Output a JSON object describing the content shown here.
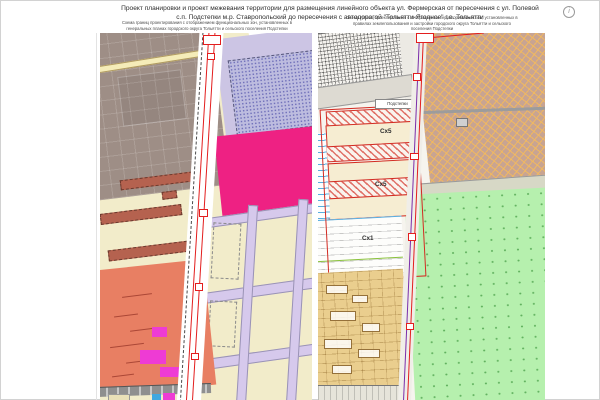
{
  "page": {
    "title_line1": "Проект планировки и проект межевания территории для размещения линейного объекта ул. Фермерская от пересечения с ул. Полевой",
    "title_line2": "с.п. Подстепки м.р. Ставропольский до пересечения с автодорогой \"Тольятти-Ягодное\" г.о. Тольятти",
    "info_icon_glyph": "i"
  },
  "left_panel": {
    "caption": "Схема границ проектирования с отображением функциональных зон, установленных в генеральных планах городского округа Тольятти и сельского поселения Подстепки"
  },
  "right_panel": {
    "caption": "Схема границ проектирования с отображением территориальных зон, установленных в правилах землепользования и застройки городского округа Тольятти и сельского поселения Подстепки",
    "settlement_label": "Подстепки",
    "zone_sx5_upper": "Сх5",
    "zone_sx5_lower": "Сх5",
    "zone_sx1": "Сх1"
  },
  "colors": {
    "boundary_red": "#e31e1e",
    "boundary_purple": "#7b2daa",
    "zone_magenta": "#ee2183",
    "zone_lavender": "#ccc5e4",
    "zone_brown_gray": "#9e8e86",
    "zone_salmon": "#e87f63",
    "zone_cream": "#f2ecca",
    "zone_green_dotted": "#b6f0ae",
    "zone_tan_hatched": "#c8a492",
    "zone_wheat_parcels": "#eace8e",
    "street_lavender": "#d6c9ec",
    "patch_magenta": "#ee3bd4"
  }
}
